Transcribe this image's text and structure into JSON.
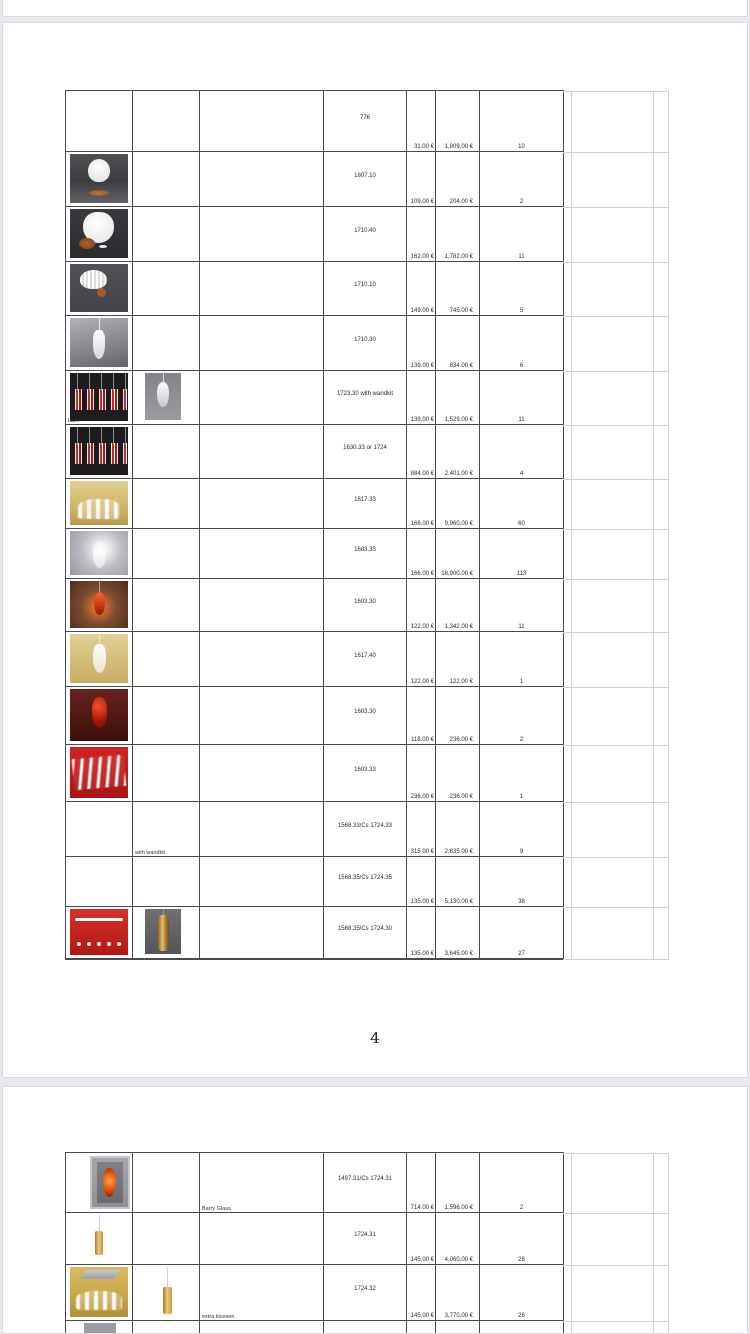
{
  "viewer": {
    "background_color": "#e8e9ee",
    "page_background": "#ffffff",
    "table_border_color": "#4a4a4e",
    "faint_grid_color": "#cfd0d5",
    "accent_red": "#c62a22",
    "accent_gold": "#ecc87c"
  },
  "page1": {
    "page_number": "4",
    "rows": [
      {
        "code": "776",
        "price_unit": "31.00 €",
        "price_total": "1,809.00 €",
        "qty": "10"
      },
      {
        "code": "1807.10",
        "price_unit": "109.00 €",
        "price_total": "204.00 €",
        "qty": "2",
        "img1": "tablelamp"
      },
      {
        "code": "1710.40",
        "price_unit": "162.00 €",
        "price_total": "1,782.00 €",
        "qty": "11",
        "img1": "walllamp"
      },
      {
        "code": "1710.10",
        "price_unit": "149.00 €",
        "price_total": "745.00 €",
        "qty": "5",
        "img1": "ceillamp"
      },
      {
        "code": "1710.30",
        "price_unit": "139.00 €",
        "price_total": "834.00 €",
        "qty": "6",
        "img1": "droppendant"
      },
      {
        "code": "1723.30 with wandkit",
        "price_unit": "139.00 €",
        "price_total": "1,529.00 €",
        "qty": "11",
        "img1": "stripes",
        "img2": "smokependant",
        "note1": "Lam"
      },
      {
        "code": "1630.33 or 1724",
        "price_unit": "884.00 €",
        "price_total": "2,401.00 €",
        "qty": "4",
        "img1": "stripes"
      },
      {
        "code": "1617.33",
        "price_unit": "166.00 €",
        "price_total": "9,960.00 €",
        "qty": "60",
        "img1": "goldroom"
      },
      {
        "code": "1603.33",
        "price_unit": "166.00 €",
        "price_total": "18,900.00 €",
        "qty": "113",
        "img1": "glowpendant"
      },
      {
        "code": "1603.30",
        "price_unit": "122.00 €",
        "price_total": "1,342.00 €",
        "qty": "11",
        "img1": "redwarm"
      },
      {
        "code": "1617.40",
        "price_unit": "122.00 €",
        "price_total": "122.00 €",
        "qty": "1",
        "img1": "creamdrop"
      },
      {
        "code": "1603.30",
        "price_unit": "118.00 €",
        "price_total": "236.00 €",
        "qty": "2",
        "img1": "reddrop"
      },
      {
        "code": "1603.33",
        "price_unit": "236.00 €",
        "price_total": "236.00 €",
        "qty": "1",
        "img1": "redcones"
      },
      {
        "code": "1568.33/Cs 1724.33",
        "price_unit": "315.00 €",
        "price_total": "2,835.00 €",
        "qty": "9",
        "note2": "with wandkit"
      },
      {
        "code": "1568.35/Cs 1724.35",
        "price_unit": "135.00 €",
        "price_total": "5,130.00 €",
        "qty": "38"
      },
      {
        "code": "1568.35/Cs 1724.30",
        "price_unit": "135.00 €",
        "price_total": "3,645.00 €",
        "qty": "27",
        "img1": "redbardots",
        "img2": "goldtwist"
      }
    ]
  },
  "page2": {
    "rows": [
      {
        "code": "1497.31/Cs 1724.31",
        "price_unit": "714.00 €",
        "price_total": "1,596.00 €",
        "qty": "2",
        "img1": "orangevase",
        "note3": "Barry Glass"
      },
      {
        "code": "1724.31",
        "price_unit": "145.00 €",
        "price_total": "4,060.00 €",
        "qty": "28",
        "img1": "goldcyl"
      },
      {
        "code": "1724.32",
        "price_unit": "145.00 €",
        "price_total": "3,770.00 €",
        "qty": "26",
        "img1": "goldroom2",
        "img2": "goldcylsmall",
        "note3": "extra klossen"
      },
      {
        "code": "",
        "img1": "graytop"
      }
    ]
  }
}
